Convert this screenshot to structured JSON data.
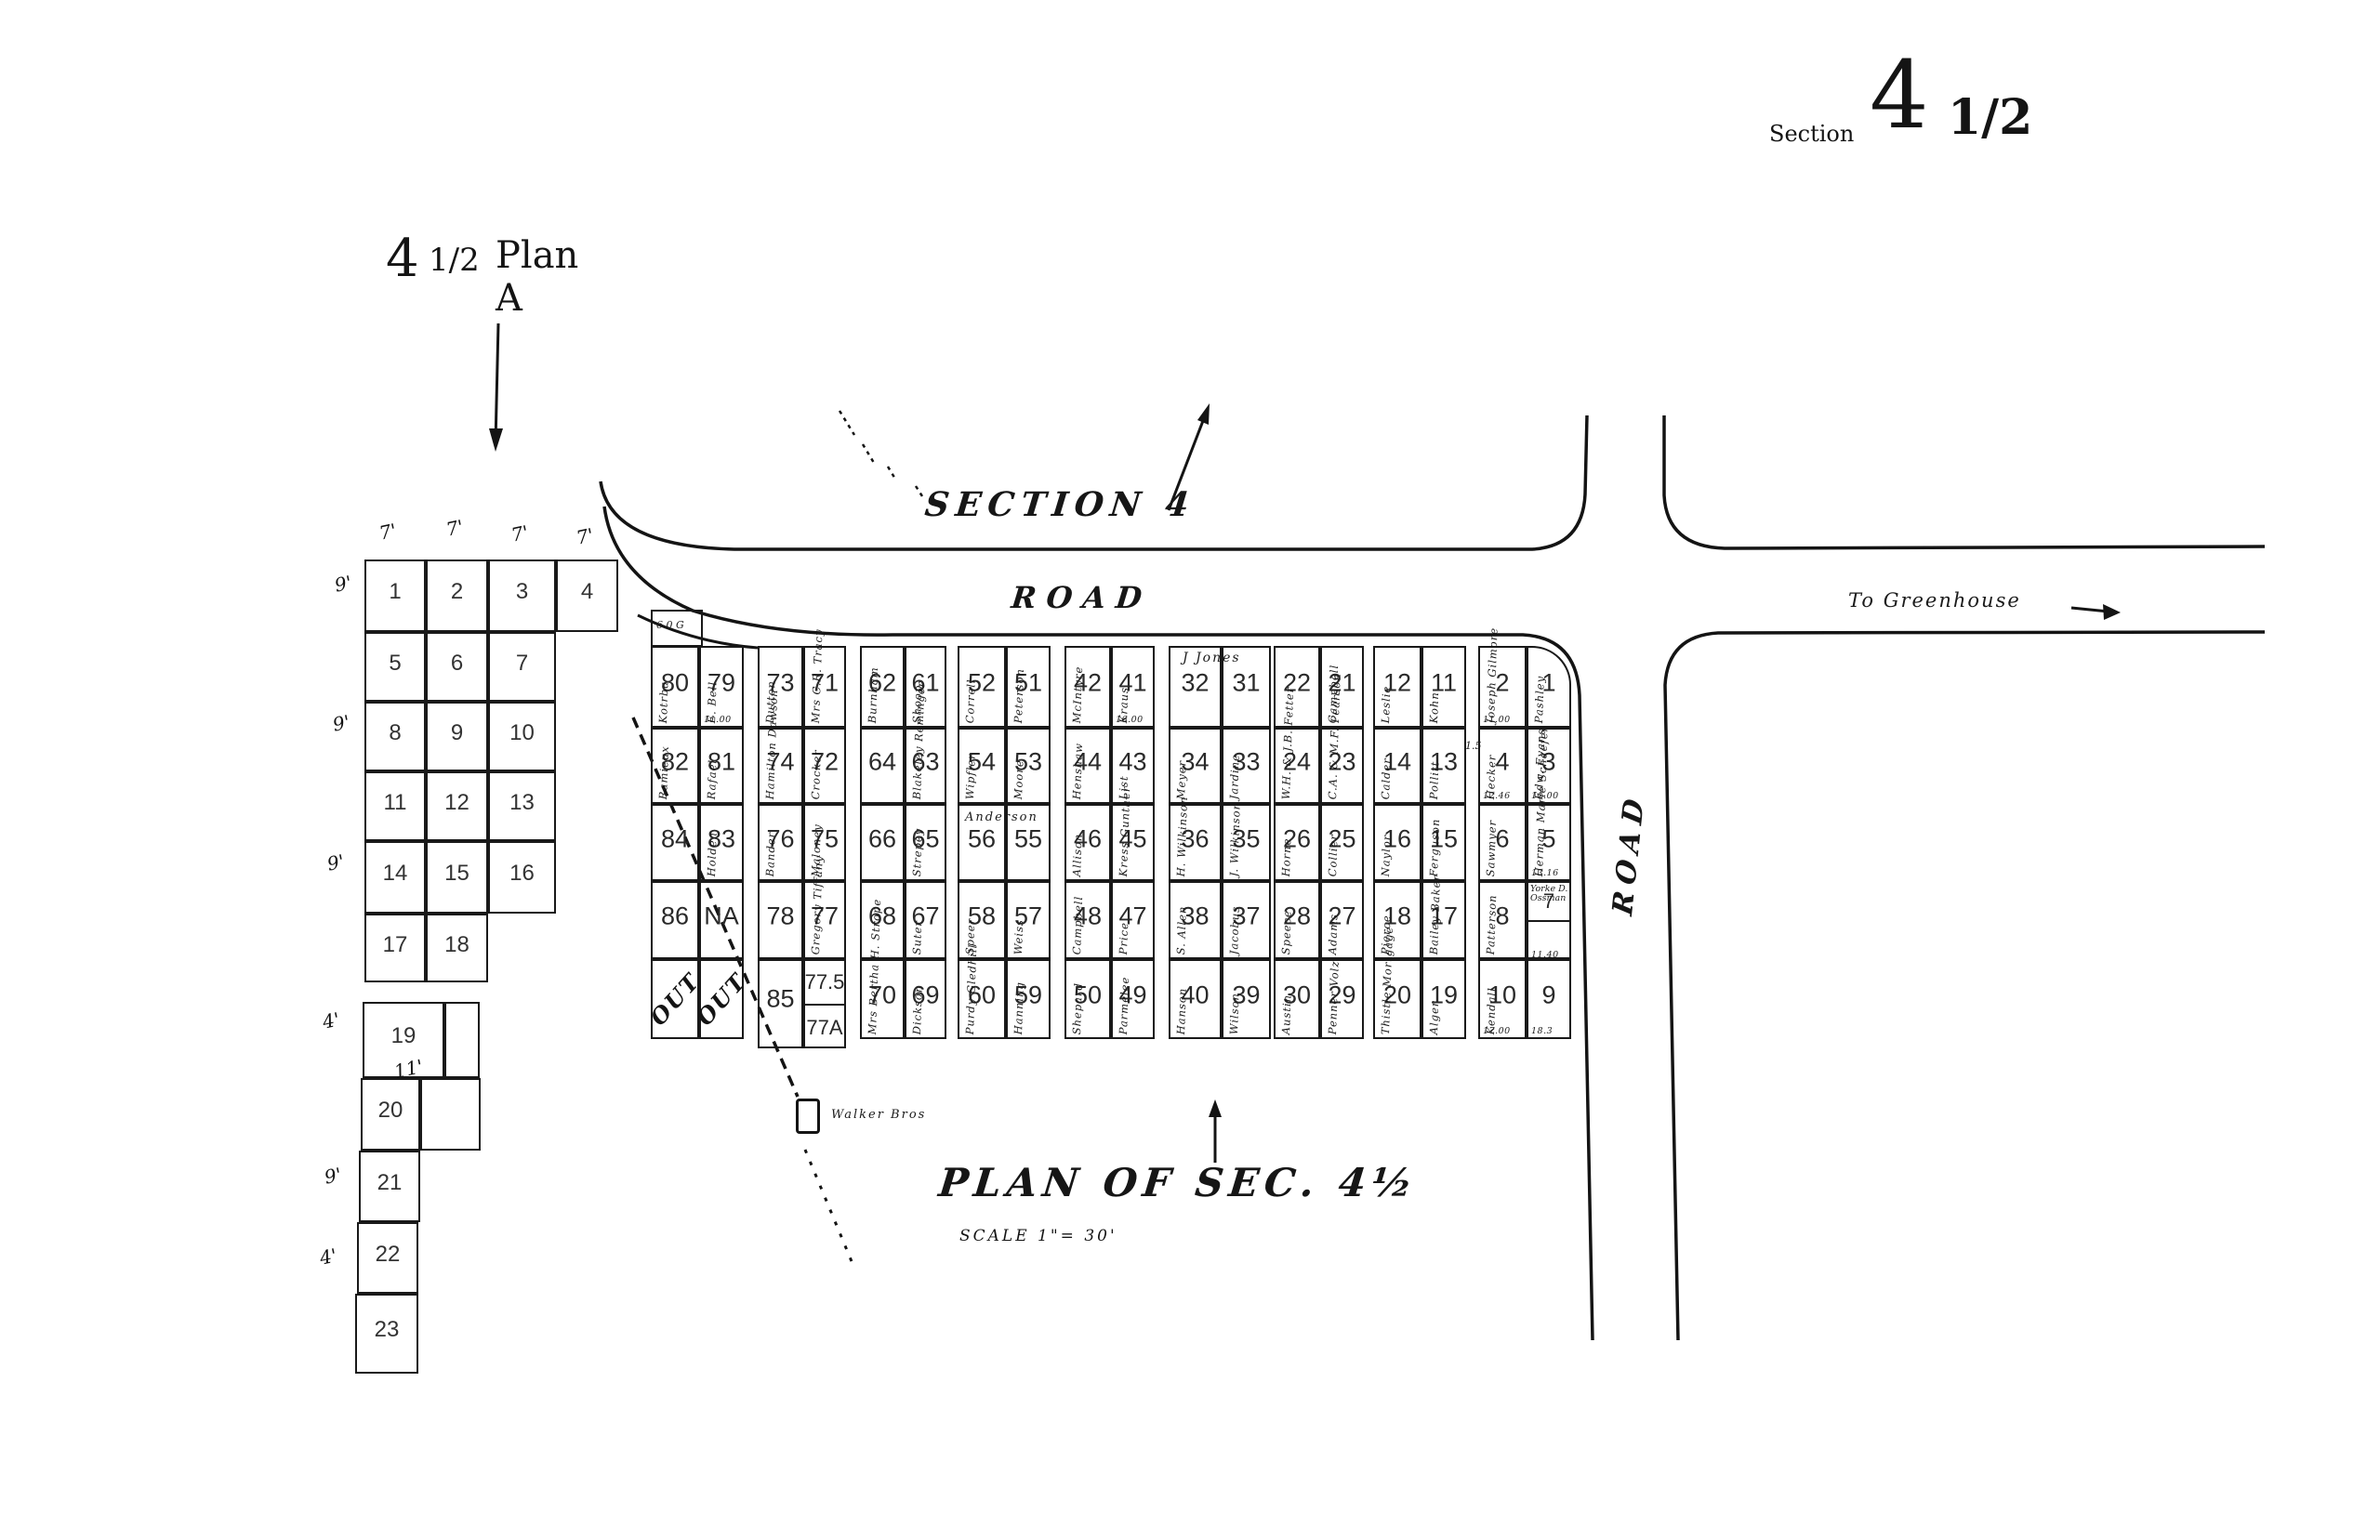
{
  "page_title": {
    "word": "Section",
    "big_number": "4",
    "fraction": "1/2"
  },
  "plan_a": {
    "heading": {
      "number": "4",
      "fraction": "1/2",
      "name": "Plan A"
    },
    "top_dims": [
      "7'",
      "7'",
      "7'",
      "7'"
    ],
    "side_dims": [
      "9'",
      "9'",
      "9'",
      "4'",
      "11'",
      "9'",
      "4'"
    ],
    "cells": [
      "1",
      "2",
      "3",
      "4",
      "5",
      "6",
      "7",
      "8",
      "9",
      "10",
      "11",
      "12",
      "13",
      "14",
      "15",
      "16",
      "17",
      "18",
      "19",
      "",
      "20",
      "",
      "21",
      "22",
      "23"
    ]
  },
  "roads": {
    "section_label": "SECTION 4",
    "road_top_label": "ROAD",
    "road_right_label": "ROAD",
    "greenhouse_label": "To Greenhouse"
  },
  "annotations": {
    "annex": "6.0 G",
    "alley_width": "1.5",
    "jones_span": "J Jones",
    "anderson_span": "Anderson",
    "square_label": "Walker Bros"
  },
  "footer": {
    "plan_title": "PLAN OF SEC. 4½",
    "scale": "SCALE 1\"= 30'"
  },
  "main_grid": {
    "blocks": [
      {
        "rows": [
          [
            {
              "n": "80",
              "name": "Kotrba"
            },
            {
              "n": "79",
              "name": "E. Bell",
              "fee": "11.00"
            }
          ],
          [
            {
              "n": "82",
              "name": "Ramieux"
            },
            {
              "n": "81",
              "name": "Rafael"
            }
          ],
          [
            {
              "n": "84",
              "name": ""
            },
            {
              "n": "83",
              "name": "Holden"
            }
          ],
          [
            {
              "n": "86",
              "name": ""
            },
            {
              "n": "NA",
              "name": ""
            }
          ],
          [
            {
              "n": "OUT",
              "out": true
            },
            {
              "n": "OUT",
              "out": true
            }
          ]
        ]
      },
      {
        "rows": [
          [
            {
              "n": "73",
              "name": "Dutton"
            },
            {
              "n": "71",
              "name": "Mrs C.R. Tracy"
            }
          ],
          [
            {
              "n": "74",
              "name": "Hamilton Dawson"
            },
            {
              "n": "72",
              "name": "Crocker"
            }
          ],
          [
            {
              "n": "76",
              "name": "Bander"
            },
            {
              "n": "75",
              "name": "Maloney"
            }
          ],
          [
            {
              "n": "78",
              "name": ""
            },
            {
              "n": "77",
              "name": "Gregory Tiffany"
            }
          ],
          [
            {
              "n": "85",
              "name": ""
            },
            {
              "split": [
                {
                  "n": "77.5"
                },
                {
                  "n": "77A"
                }
              ]
            }
          ]
        ]
      },
      {
        "rows": [
          [
            {
              "n": "62",
              "name": "Burnham"
            },
            {
              "n": "61",
              "name": "Shoop"
            }
          ],
          [
            {
              "n": "64",
              "name": ""
            },
            {
              "n": "63",
              "name": "Blakeley Reminger"
            }
          ],
          [
            {
              "n": "66",
              "name": ""
            },
            {
              "n": "65",
              "name": "Strepey"
            }
          ],
          [
            {
              "n": "68",
              "name": ""
            },
            {
              "n": "67",
              "name": "Suter"
            }
          ],
          [
            {
              "n": "70",
              "name": "Mrs Bertha H. Strope"
            },
            {
              "n": "69",
              "name": "Dickson"
            }
          ]
        ]
      },
      {
        "rows": [
          [
            {
              "n": "52",
              "name": "Correll"
            },
            {
              "n": "51",
              "name": "Peterson"
            }
          ],
          [
            {
              "n": "54",
              "name": "Wipfler"
            },
            {
              "n": "53",
              "name": "Moore"
            }
          ],
          [
            {
              "n": "56",
              "name": ""
            },
            {
              "n": "55",
              "name": ""
            }
          ],
          [
            {
              "n": "58",
              "name": "Speer"
            },
            {
              "n": "57",
              "name": "Weiss"
            }
          ],
          [
            {
              "n": "60",
              "name": "Purdy Gledhill"
            },
            {
              "n": "59",
              "name": "Hanning"
            }
          ]
        ]
      },
      {
        "rows": [
          [
            {
              "n": "42",
              "name": "McIntyre"
            },
            {
              "n": "41",
              "name": "Kraus",
              "fee": "16.00"
            }
          ],
          [
            {
              "n": "44",
              "name": "Henshaw"
            },
            {
              "n": "43",
              "name": "List"
            }
          ],
          [
            {
              "n": "46",
              "name": "Allison"
            },
            {
              "n": "45",
              "name": "Kress Gunther"
            }
          ],
          [
            {
              "n": "48",
              "name": "Campbell"
            },
            {
              "n": "47",
              "name": "Price"
            }
          ],
          [
            {
              "n": "50",
              "name": "Shepard"
            },
            {
              "n": "49",
              "name": "Parmelee"
            }
          ]
        ]
      },
      {
        "rows": [
          [
            {
              "n": "32",
              "name": ""
            },
            {
              "n": "31",
              "name": ""
            }
          ],
          [
            {
              "n": "34",
              "name": "Meyer"
            },
            {
              "n": "33",
              "name": "Jardine"
            }
          ],
          [
            {
              "n": "36",
              "name": "H. Wilkinson"
            },
            {
              "n": "35",
              "name": "J. Wilkinson"
            }
          ],
          [
            {
              "n": "38",
              "name": "S. Allen"
            },
            {
              "n": "37",
              "name": "Jacobus"
            }
          ],
          [
            {
              "n": "40",
              "name": "Hanson"
            },
            {
              "n": "39",
              "name": "Wilson"
            }
          ]
        ]
      },
      {
        "rows": [
          [
            {
              "n": "22",
              "name": ""
            },
            {
              "n": "21",
              "name": "Campbell"
            }
          ],
          [
            {
              "n": "24",
              "name": "W.H. & J.B. Fetter"
            },
            {
              "n": "23",
              "name": "C.A. & M.F. Pearson"
            }
          ],
          [
            {
              "n": "26",
              "name": "Horne"
            },
            {
              "n": "25",
              "name": "Collier"
            }
          ],
          [
            {
              "n": "28",
              "name": "Speece"
            },
            {
              "n": "27",
              "name": "Adams"
            }
          ],
          [
            {
              "n": "30",
              "name": "Austin"
            },
            {
              "n": "29",
              "name": "Penner Volz"
            }
          ]
        ]
      },
      {
        "rows": [
          [
            {
              "n": "12",
              "name": "Leslie"
            },
            {
              "n": "11",
              "name": "Kohn"
            }
          ],
          [
            {
              "n": "14",
              "name": "Calder"
            },
            {
              "n": "13",
              "name": "Pollitt"
            }
          ],
          [
            {
              "n": "16",
              "name": "Naylor"
            },
            {
              "n": "15",
              "name": "Ferguson"
            }
          ],
          [
            {
              "n": "18",
              "name": "Pierce"
            },
            {
              "n": "17",
              "name": "Bailey Baker"
            }
          ],
          [
            {
              "n": "20",
              "name": "Thistle Mortgage"
            },
            {
              "n": "19",
              "name": "Alger"
            }
          ]
        ]
      },
      {
        "rows": [
          [
            {
              "n": "2",
              "name": "Joseph Gilmore",
              "fee": "11.00"
            },
            {
              "n": "1",
              "name": "Pashley",
              "round": true
            }
          ],
          [
            {
              "n": "4",
              "name": "Hecker",
              "fee": "12.46"
            },
            {
              "n": "3",
              "name": "Edw. Evans",
              "fee": "11.00"
            }
          ],
          [
            {
              "n": "6",
              "name": "Sawmyer"
            },
            {
              "n": "5",
              "name": "Herman Marie Schaefer",
              "fee": "13.16"
            }
          ],
          [
            {
              "n": "8",
              "name": "Patterson"
            },
            {
              "split": [
                {
                  "n": "7",
                  "name": "Yorke D. Ossman"
                },
                {
                  "n": "",
                  "fee": "11.40"
                }
              ]
            }
          ],
          [
            {
              "n": "10",
              "name": "Kendall",
              "fee": "17.00"
            },
            {
              "n": "9",
              "name": "",
              "fee": "18.3"
            }
          ]
        ]
      }
    ]
  }
}
